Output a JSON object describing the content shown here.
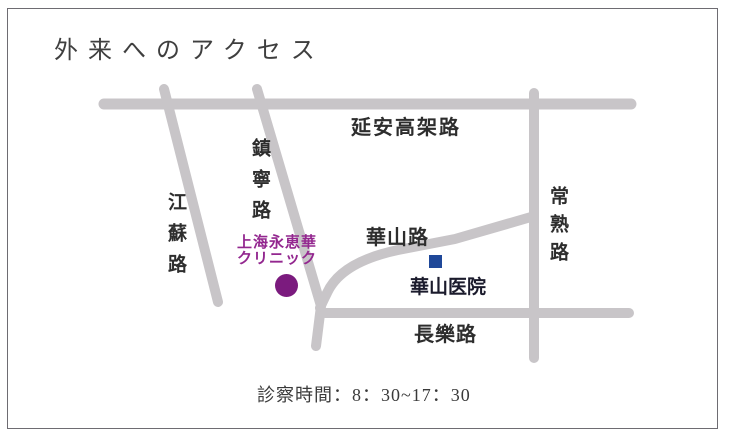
{
  "page": {
    "title": "外来へのアクセス",
    "hours": "診察時間：8：30~17：30"
  },
  "map": {
    "road_color": "#C8C5C8",
    "roads": {
      "yanan": {
        "label": "延安高架路",
        "orientation": "horizontal"
      },
      "jiangsu": {
        "label": "江蘇路",
        "orientation": "vertical"
      },
      "zhenning": {
        "label": "鎮寧路",
        "orientation": "vertical"
      },
      "changshu": {
        "label": "常熟路",
        "orientation": "vertical"
      },
      "huashan": {
        "label": "華山路",
        "orientation": "diagonal"
      },
      "changle": {
        "label": "長樂路",
        "orientation": "horizontal"
      }
    },
    "clinic": {
      "name_line1": "上海永恵華",
      "name_line2": "クリニック",
      "marker": "circle",
      "marker_color": "#7B1B7E",
      "text_color": "#93278F"
    },
    "hospital": {
      "name": "華山医院",
      "marker": "square",
      "marker_color": "#1F4899"
    }
  }
}
